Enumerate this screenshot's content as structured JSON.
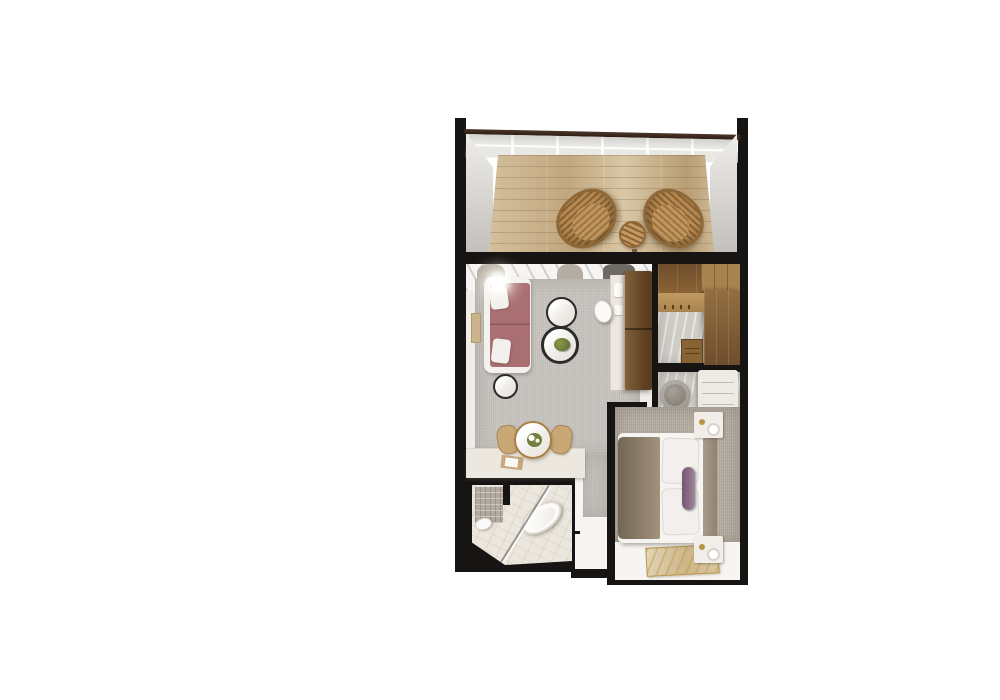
{
  "palette": {
    "wall": "#171513",
    "deck-a": "#d4bf9c",
    "deck-b": "#c1a77f",
    "side-wall-a": "#efedea",
    "side-wall-b": "#c3c0bc",
    "rail-bar": "#4d362a",
    "glass-a": "#e9e8e4",
    "glass-line": "#fdfdfc",
    "wicker-a": "#b68a52",
    "wicker-b": "#8a6233",
    "wicker-border": "#8f6838",
    "floor-warm": "#f0ede9",
    "rug": "#c8c5c0",
    "curtain-a": "#b4aca1",
    "curtain-c": "#6f6a64",
    "sofa-a": "#a96f73",
    "sofa-b": "#8f575c",
    "sofa-frame": "#f4f2ef",
    "pillow": "#f2f0ec",
    "rim": "#2b2b2b",
    "marble": "#efece7",
    "plant": "#6d7a3a",
    "art": "#cbb48c",
    "desk": "#ece7df",
    "cab-dark-a": "#82603a",
    "cab-dark-b": "#5b3d20",
    "cab-mid": "#6f4e2d",
    "cab-light": "#a8834f",
    "stone": "#cfccc6",
    "pouf-a": "#a8a199",
    "pouf-b": "#7d766d",
    "bench": "#eeebe5",
    "carpet": "#b8b0a5",
    "bed": "#f6f4f1",
    "throw": "#8d7d6a",
    "bolster": "#8e7086",
    "headboard": "#a99c8b",
    "gold": "#b99343",
    "floor-white": "#f6f5f2",
    "rug-art-a": "#e2d5ba",
    "rug-art-b": "#d8c9a4",
    "tile": "#b2a9a1",
    "bath-marble": "#ebe7df",
    "chair-tan": "#c9a876",
    "table-gold": "#a97f45"
  },
  "floor_plan": {
    "view": "top-down 3d render of a hotel suite, centered on white background",
    "rooms": [
      {
        "name": "balcony",
        "items": [
          "wicker lounge chair",
          "wicker lounge chair",
          "round wicker side table",
          "glass railing with dark top bar",
          "wood plank deck",
          "white side walls"
        ]
      },
      {
        "name": "living-room",
        "items": [
          "white-framed sofa with mauve cushions",
          "two white throw pillows",
          "glowing floor lamp",
          "round marble coffee table",
          "round marble coffee table with green plant",
          "round black-rim side table",
          "tan wall art",
          "sheer curtains at balcony door",
          "desk with white pads",
          "white desk chair",
          "tall dark wood media cabinet",
          "grey area rug"
        ]
      },
      {
        "name": "dining-nook",
        "items": [
          "round gold-rim dining table",
          "white flower centerpiece",
          "two tan dining chairs",
          "white credenza with tray and book"
        ]
      },
      {
        "name": "walk-in-closet",
        "items": [
          "dark wood upper cabinets",
          "wood wardrobe wall",
          "hanging rail with hangers",
          "small dresser",
          "stone floor"
        ]
      },
      {
        "name": "entry",
        "items": [
          "round grey pouf",
          "white upholstered bench",
          "stone floor"
        ]
      },
      {
        "name": "bedroom",
        "items": [
          "double bed with white duvet",
          "taupe throw blanket",
          "two white pillows",
          "purple bolster pillow",
          "taupe headboard on right wall",
          "nightstand with lamp and gold bowl (top)",
          "nightstand with lamp and gold bowl (bottom)",
          "taupe carpet",
          "white floor strip",
          "gold abstract area rug"
        ]
      },
      {
        "name": "bathroom",
        "items": [
          "freestanding oval bathtub set diagonally",
          "toilet",
          "diagonal glass shower partition",
          "mosaic tile accent wall",
          "gold-veined marble floor",
          "door handle to hallway"
        ]
      },
      {
        "name": "hallway",
        "items": [
          "white floor",
          "grey runner from living room"
        ]
      }
    ]
  }
}
